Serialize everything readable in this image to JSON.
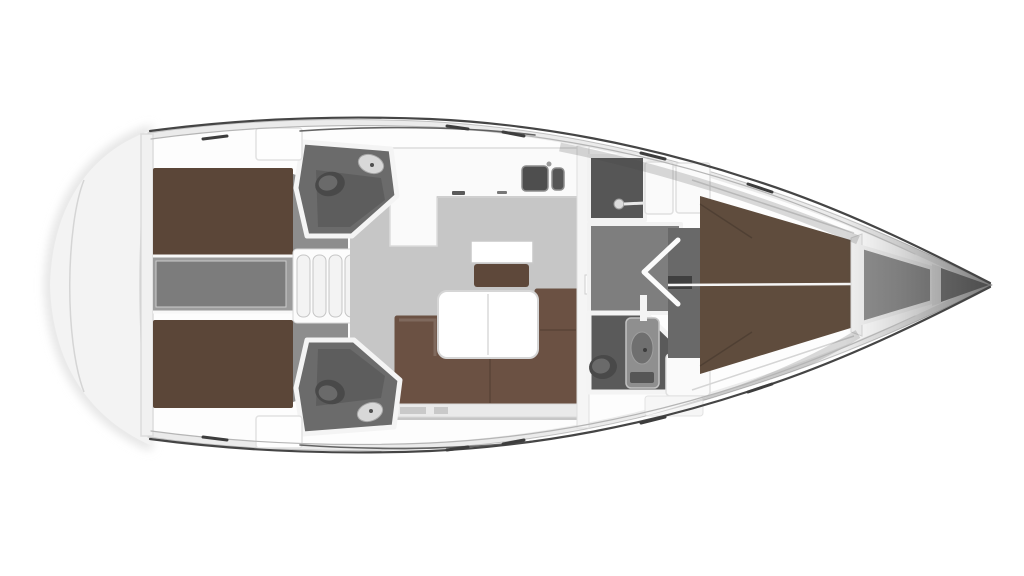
{
  "meta": {
    "description": "top-down interior floor plan of a sailing yacht, bow pointing right, no text labels",
    "orientation": "bow-right"
  },
  "colors": {
    "background": "#ffffff",
    "hull": "#fdfdfd",
    "transom": "#f3f3f3",
    "stern_wall": "#f1f1f1",
    "outline": "#474747",
    "toe_rail": "#b5b5b5",
    "bed": "#5b4638",
    "cabin_floor": "#8d8d8d",
    "corridor": "#9c9c9c",
    "engine_hatch": "#7c7c7c",
    "stair": "#f3f3f3",
    "head_floor": "#6b6b6b",
    "toilet": "#494949",
    "toilet_lid": "#6a6a6a",
    "sink": "#d8d8d8",
    "salon_floor": "#c6c6c6",
    "counter": "#fafafa",
    "galley_sink": "#4e4e4e",
    "galley_sink_small": "#565656",
    "nav_table": "#ffffff",
    "nav_seat": "#5e483a",
    "table": "#ffffff",
    "sofa": "#6b5143",
    "drawer_strip": "#eaeaea",
    "drawer": "#c9c9c9",
    "bulkhead": "#f5f5f5",
    "tv": "#383838",
    "shower_floor": "#565656",
    "fwd_corridor": "#7e7e7e",
    "fwd_head_floor": "#5a5a5a",
    "vanity": "#8f8f8f",
    "basin": "#6f6f6f",
    "wardrobe": "#fafafa",
    "seat_white": "#fafafa",
    "fwd_bed": "#5f4c3d",
    "fwd_cabin_floor": "#696969",
    "anchor_locker": "#8f8f8f",
    "bow_tip": "#7e7e7e",
    "door": "#fbfbfb",
    "step": "#3f3f3f",
    "centerline": "#f5f5f5",
    "hatch": "#fefefe"
  },
  "regions": [
    "transom",
    "aft-cabin-port",
    "aft-cabin-starboard",
    "engine-compartment",
    "companionway-stairs",
    "aft-head-port",
    "aft-head-starboard",
    "salon",
    "galley",
    "nav-station",
    "saloon-table",
    "u-sofa",
    "main-bulkhead",
    "shower",
    "forward-corridor",
    "forward-head",
    "forward-cabin-v-berth",
    "anchor-locker",
    "bow"
  ]
}
